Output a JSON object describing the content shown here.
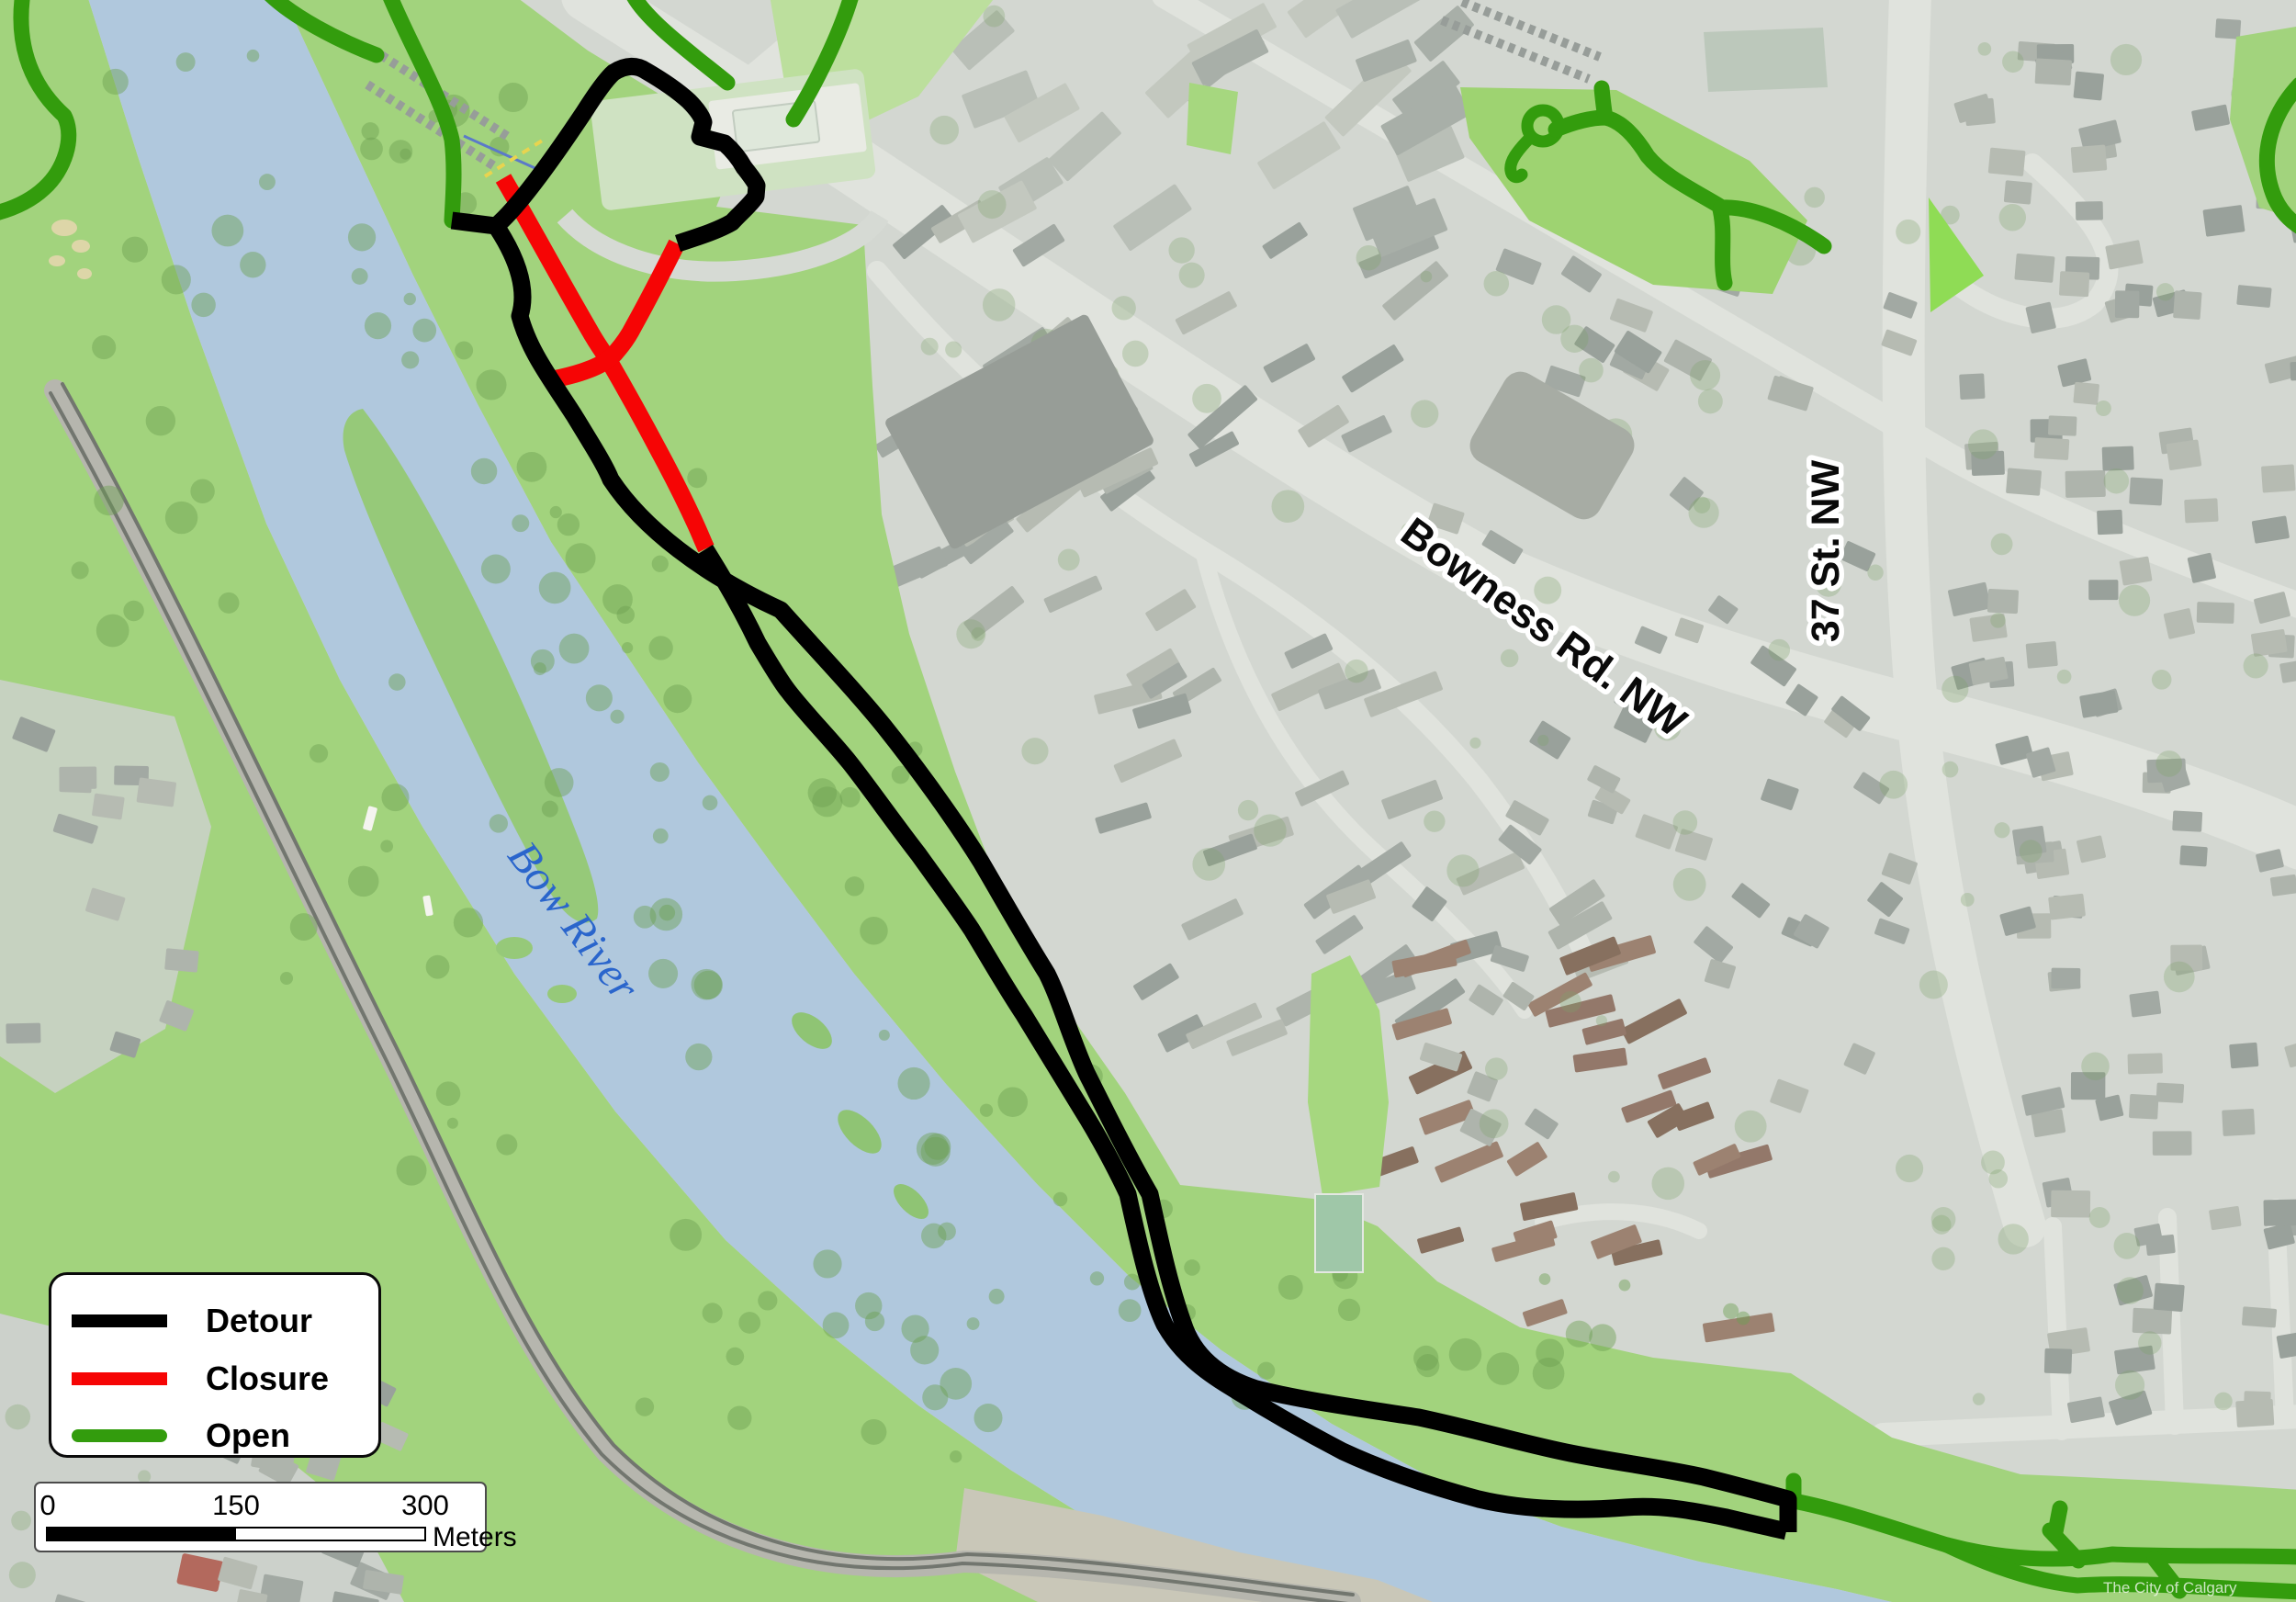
{
  "map": {
    "labels": {
      "river": "Bow River",
      "road_main": "Bowness Rd. NW",
      "road_cross": "37 St. NW",
      "watermark": "The City of Calgary"
    },
    "colors": {
      "detour": "#000000",
      "closure": "#f60505",
      "open": "#339c0d",
      "river": "#b0c8dd",
      "park": "#a2d37d",
      "river_label": "#2a65cc"
    }
  },
  "legend": {
    "items": [
      {
        "label": "Detour",
        "color": "#000000",
        "rounded": false
      },
      {
        "label": "Closure",
        "color": "#f60505",
        "rounded": false
      },
      {
        "label": "Open",
        "color": "#339c0d",
        "rounded": true
      }
    ]
  },
  "scale_bar": {
    "ticks": [
      "0",
      "150",
      "300"
    ],
    "unit": "Meters"
  }
}
